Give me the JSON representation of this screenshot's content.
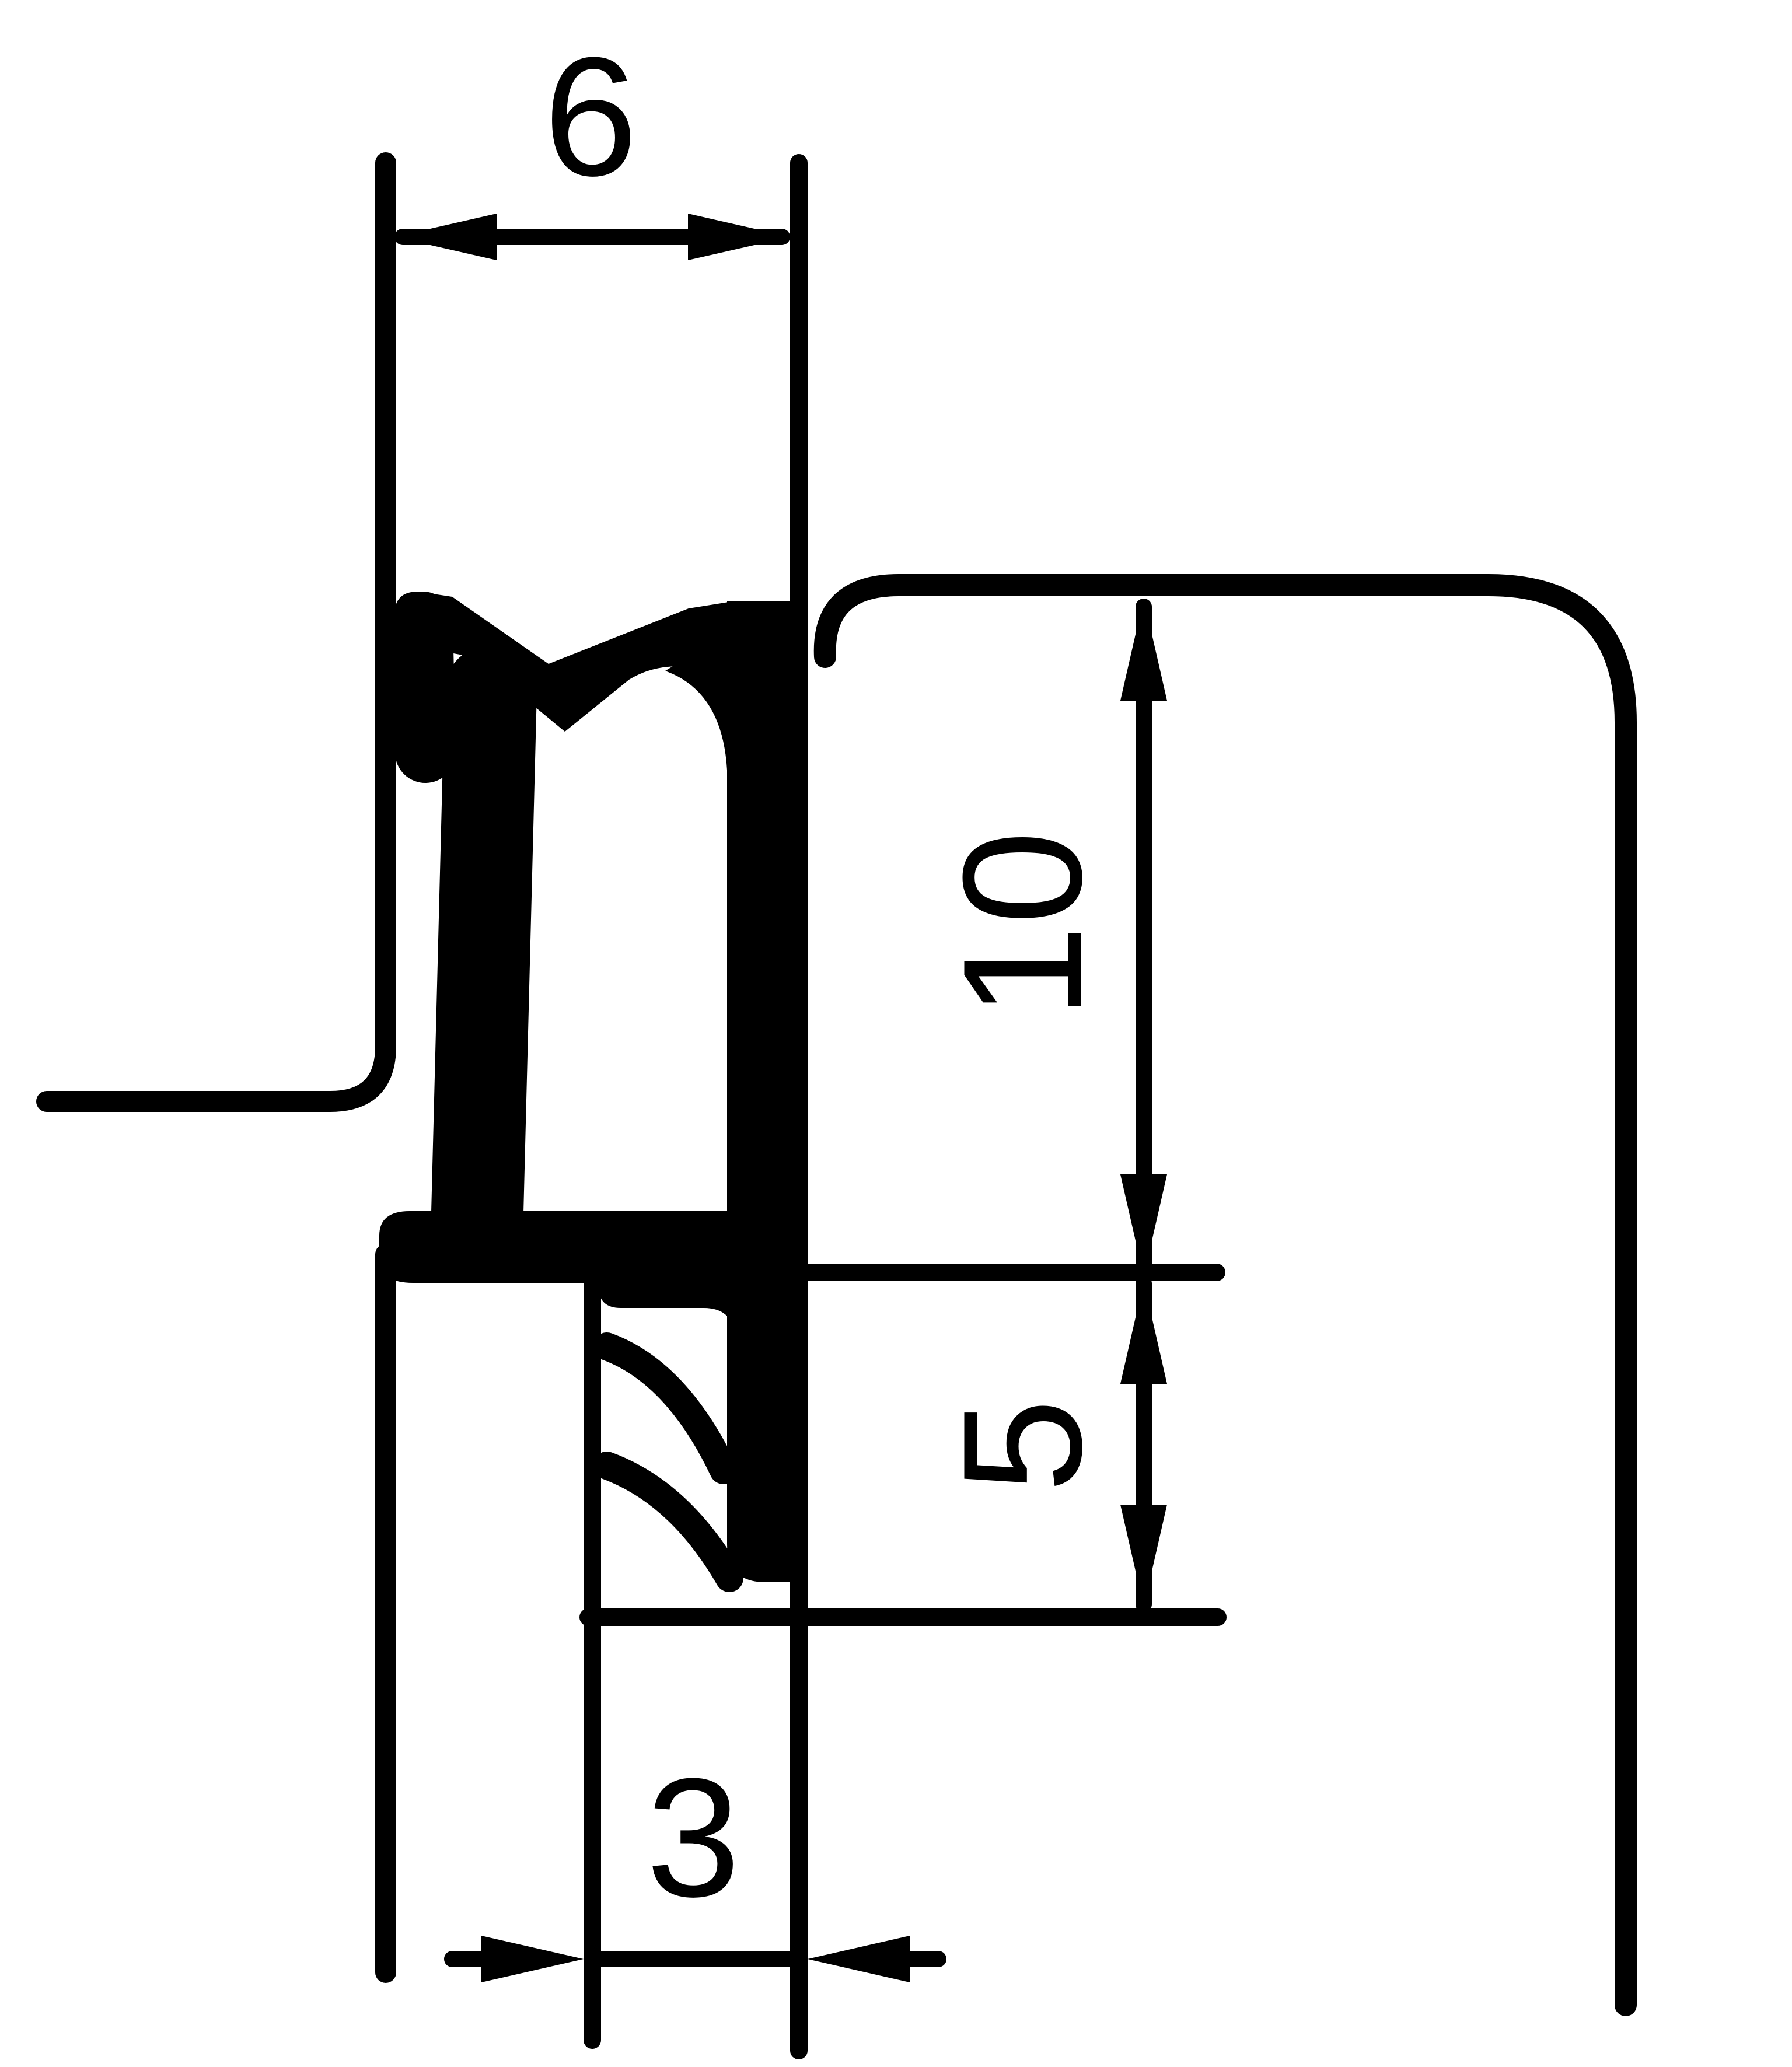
{
  "page": {
    "background_color": "#ffffff",
    "line_color": "#000000",
    "kind": "technical-cross-section-drawing"
  },
  "drawing": {
    "description": "cross-section of a rubber seal profile mounted between a sash and a frame",
    "dimension_labels": {
      "width_top": "6",
      "height_upper": "10",
      "height_lower": "5",
      "gap_bottom": "3"
    }
  }
}
